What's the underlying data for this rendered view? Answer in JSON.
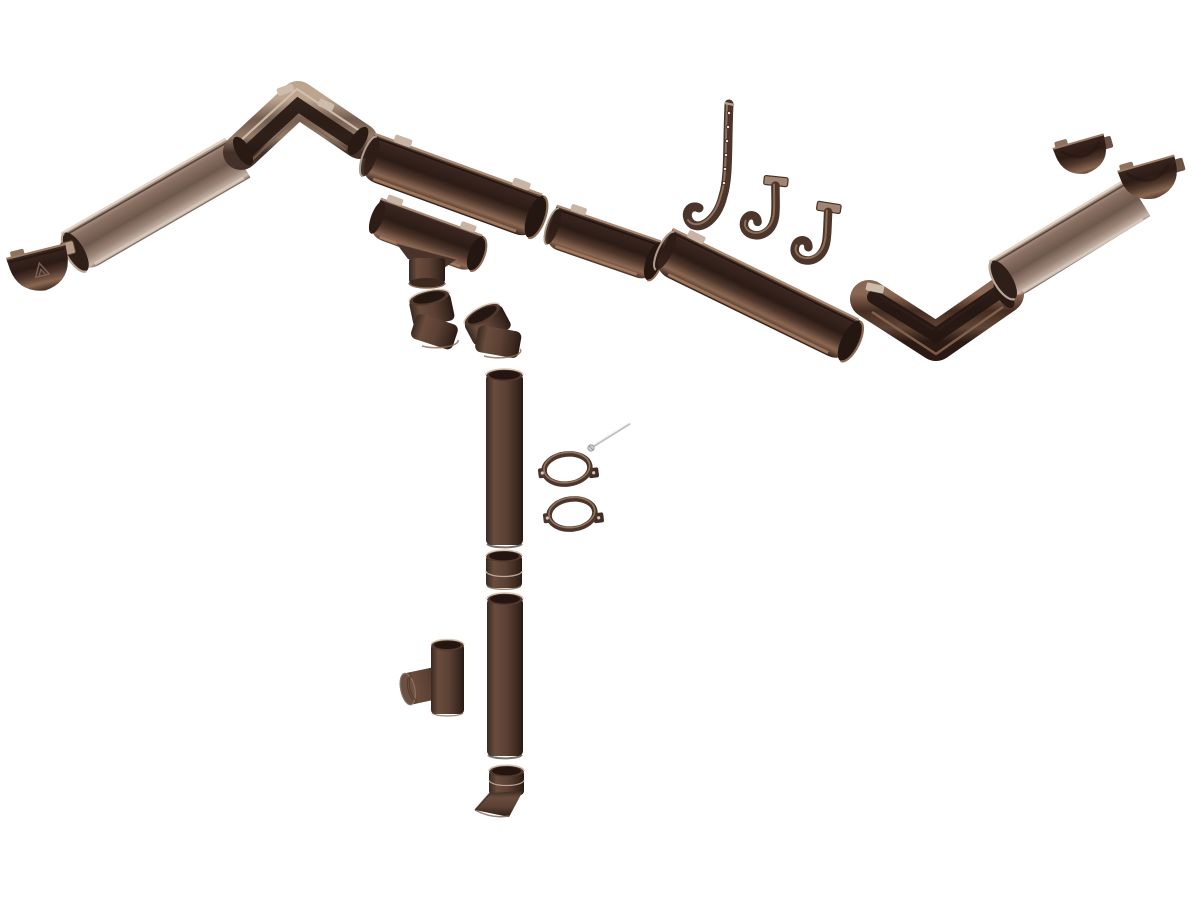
{
  "scene": {
    "description_name": "gutter-system-exploded-view",
    "background": "#ffffff",
    "palette": {
      "gutter_dark": "#4a332a",
      "gutter_dark_deep": "#241510",
      "gutter_dark_highlight": "#8a6752",
      "gutter_light": "#947d70",
      "gutter_light_highlight": "#c9b8aa",
      "pipe_brown": "#5b4034",
      "pipe_edge_dark": "#33241d",
      "interior_shadow": "#241611",
      "rim_cream": "#d8c8b8",
      "clip_tab": "#c7b4a4",
      "screw_metal": "#bfbfc2"
    }
  },
  "components": [
    {
      "id": "gutter-left-run",
      "label": "Gutter section - left run"
    },
    {
      "id": "endcap-left",
      "label": "Gutter end cap with embossed logo"
    },
    {
      "id": "corner-left",
      "label": "Gutter corner 90 deg (left)"
    },
    {
      "id": "gutter-middle-1",
      "label": "Gutter section"
    },
    {
      "id": "drop-outlet",
      "label": "Gutter drop outlet funnel"
    },
    {
      "id": "elbow-a",
      "label": "Downpipe elbow"
    },
    {
      "id": "elbow-b",
      "label": "Downpipe elbow"
    },
    {
      "id": "gutter-middle-2",
      "label": "Gutter section (short)"
    },
    {
      "id": "gutter-middle-3",
      "label": "Gutter section (long)"
    },
    {
      "id": "strap-hanger",
      "label": "Long strap gutter hanger with screw holes"
    },
    {
      "id": "fascia-bracket-1",
      "label": "Gutter hook bracket"
    },
    {
      "id": "fascia-bracket-2",
      "label": "Gutter hook bracket"
    },
    {
      "id": "corner-right",
      "label": "Gutter corner 90 deg (right)"
    },
    {
      "id": "gutter-right-run",
      "label": "Gutter section - right run"
    },
    {
      "id": "endcap-right-1",
      "label": "Gutter end cap (right pair, first)"
    },
    {
      "id": "endcap-right-2",
      "label": "Gutter end cap (right pair, second)"
    },
    {
      "id": "downpipe-1",
      "label": "Downpipe section (upper)"
    },
    {
      "id": "mounting-screw",
      "label": "Clamp mounting screw pin"
    },
    {
      "id": "pipe-clamp-1",
      "label": "Downpipe clamp ring"
    },
    {
      "id": "pipe-clamp-2",
      "label": "Downpipe clamp ring"
    },
    {
      "id": "pipe-coupler",
      "label": "Downpipe coupler socket"
    },
    {
      "id": "downpipe-2",
      "label": "Downpipe section (lower)"
    },
    {
      "id": "downpipe-tee",
      "label": "Downpipe tee branch"
    },
    {
      "id": "outlet-shoe",
      "label": "Downpipe outlet shoe"
    }
  ]
}
